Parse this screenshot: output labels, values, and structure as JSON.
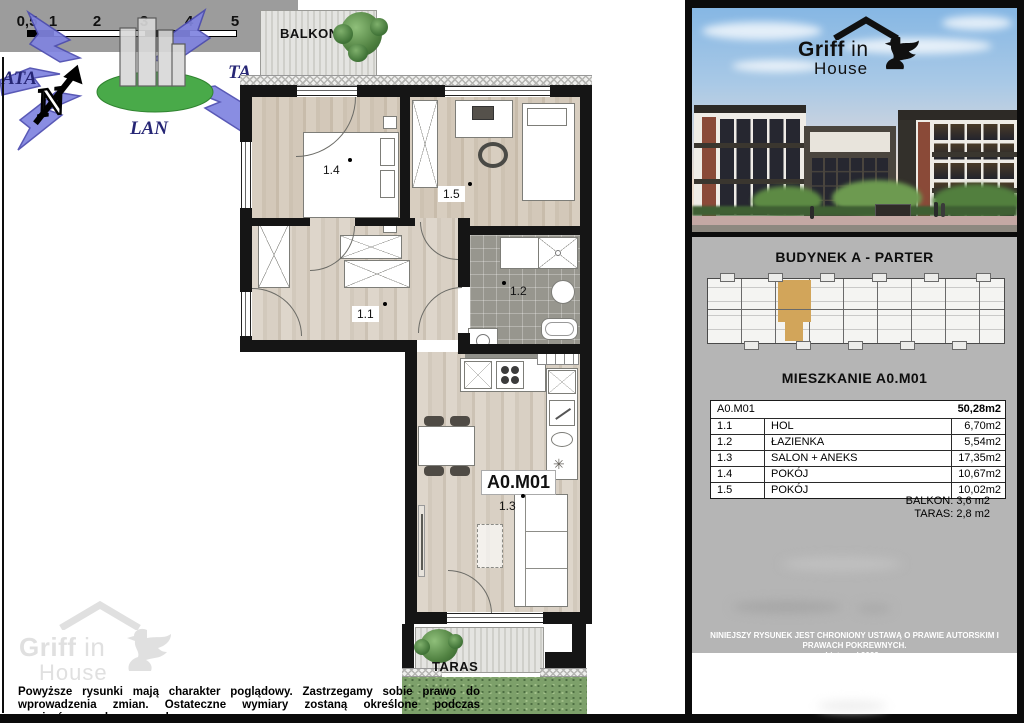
{
  "plan": {
    "balcony_label": "BALKON",
    "terrace_label": "TARAS",
    "unit_label": "A0.M01",
    "rooms": {
      "r11": "1.1",
      "r12": "1.2",
      "r13": "1.3",
      "r14": "1.4",
      "r15": "1.5"
    }
  },
  "scale_bar": {
    "labels": [
      "0,5",
      "1",
      "2",
      "3",
      "4",
      "5"
    ]
  },
  "compass": {
    "letter": "N"
  },
  "portal_watermark": {
    "left": "ATA",
    "right": "TA",
    "bottom": "LAN"
  },
  "brand": {
    "griff": "Griff",
    "in": "in",
    "house": "House"
  },
  "sidebar": {
    "building_title": "BUDYNEK A - PARTER",
    "apartment_title": "MIESZKANIE A0.M01",
    "area_table": {
      "header_unit": "A0.M01",
      "header_total": "50,28m2",
      "rows": [
        {
          "no": "1.1",
          "name": "HOL",
          "area": "6,70m2"
        },
        {
          "no": "1.2",
          "name": "ŁAZIENKA",
          "area": "5,54m2"
        },
        {
          "no": "1.3",
          "name": "SALON + ANEKS",
          "area": "17,35m2"
        },
        {
          "no": "1.4",
          "name": "POKÓJ",
          "area": "10,67m2"
        },
        {
          "no": "1.5",
          "name": "POKÓJ",
          "area": "10,02m2"
        }
      ]
    },
    "balkon_note": "BALKON: 3,6 m2",
    "taras_note": "TARAS: 2,8 m2",
    "copyright_line1": "NINIEJSZY RYSUNEK JEST CHRONIONY USTAWĄ O PRAWIE AUTORSKIM I PRAWACH POKREWNYCH.",
    "copyright_line2": "Listopad 2023r."
  },
  "footer": {
    "disclaimer_line1": "Powyższe rysunki mają charakter poglądowy.  Zastrzegamy sobie prawo do wprowadzenia zmian. Ostateczne wymiary zostaną określone podczas",
    "disclaimer_line2": "pomiarów powykonawczych."
  },
  "colors": {
    "highlight_unit": "#d2a55a",
    "panel_gray": "#b5b5b5",
    "wall_black": "#151515",
    "wood_floor": "#d3c8b9",
    "bath_tile": "#97968e",
    "grass_green": "#7da06a",
    "sky_blue": "#86b7e4",
    "portal_arrow_blue": "#8084e0"
  }
}
